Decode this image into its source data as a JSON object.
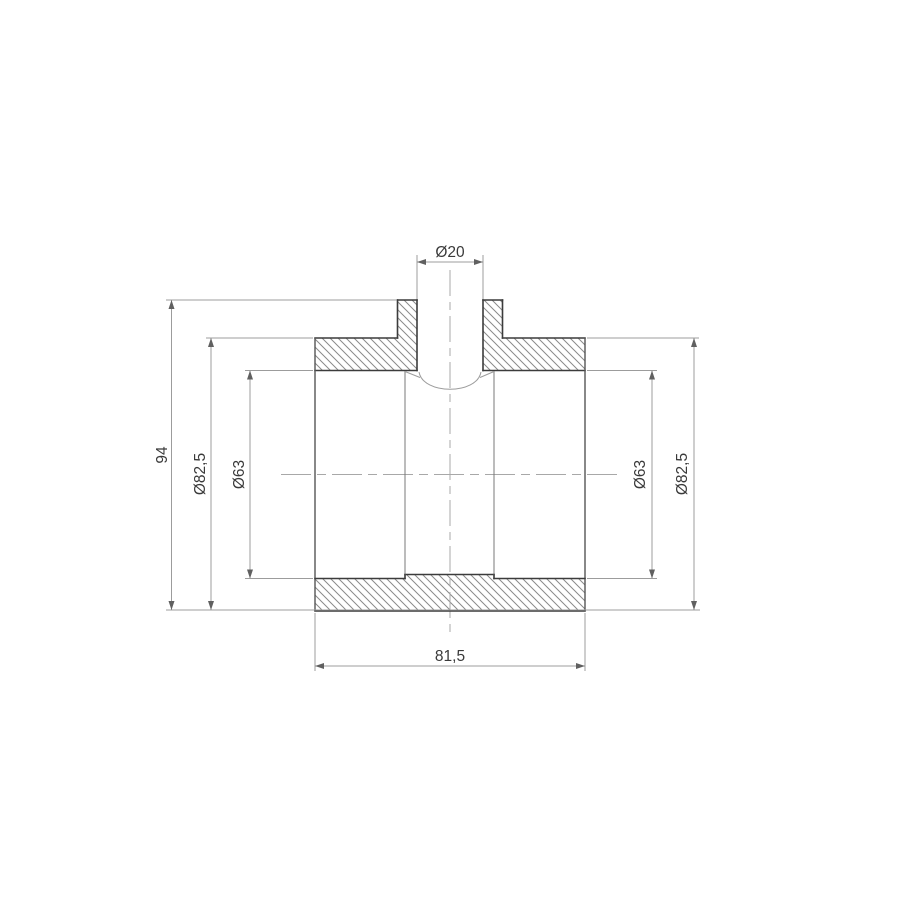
{
  "drawing": {
    "type": "technical-cross-section",
    "subject": "pipe-tee-fitting-section-view",
    "colors": {
      "background": "#ffffff",
      "object_line": "#3c3c3c",
      "thin_line": "#9c9c9c",
      "hatch_line": "#8a8a8a",
      "text": "#3a3a3a"
    },
    "dimensions": {
      "top_port_diameter": "Ø20",
      "total_height": "94",
      "left_outer_diameter": "Ø82,5",
      "left_bore_diameter": "Ø63",
      "right_bore_diameter": "Ø63",
      "right_outer_diameter": "Ø82,5",
      "body_length": "81,5"
    }
  }
}
